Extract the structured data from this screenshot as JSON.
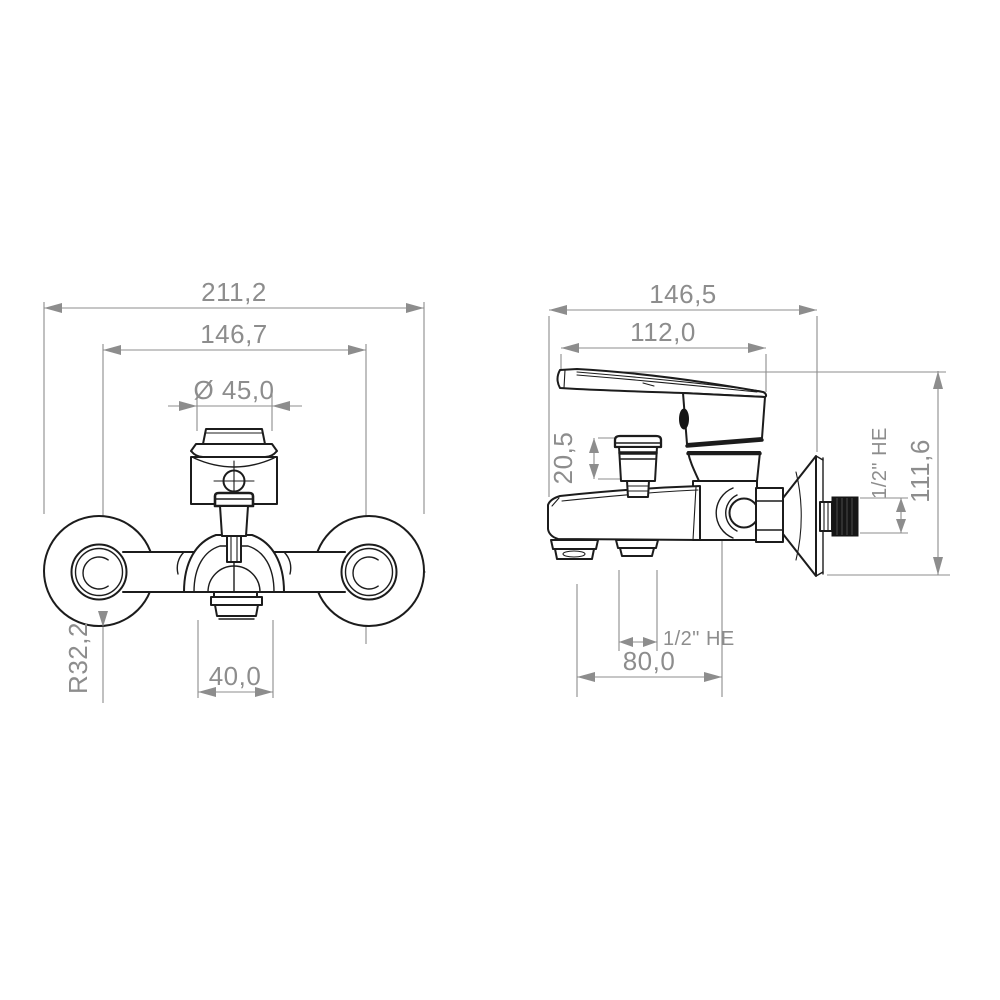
{
  "page": {
    "background": "#ffffff"
  },
  "drawing": {
    "colors": {
      "part_line": "#1c1c1c",
      "dimension": "#8d8d8d"
    },
    "front_view": {
      "overall_width": "211,2",
      "connection_spacing": "146,7",
      "handle_diameter": "Ø 45,0",
      "spout_width": "40,0",
      "flange_radius": "R32,2"
    },
    "side_view": {
      "overall_depth": "146,5",
      "handle_reach": "112,0",
      "diverter_height": "20,5",
      "overall_height": "111,6",
      "wall_connection_thread": "1/2\" HE",
      "shower_outlet_thread": "1/2\" HE",
      "spout_projection": "80,0"
    }
  }
}
